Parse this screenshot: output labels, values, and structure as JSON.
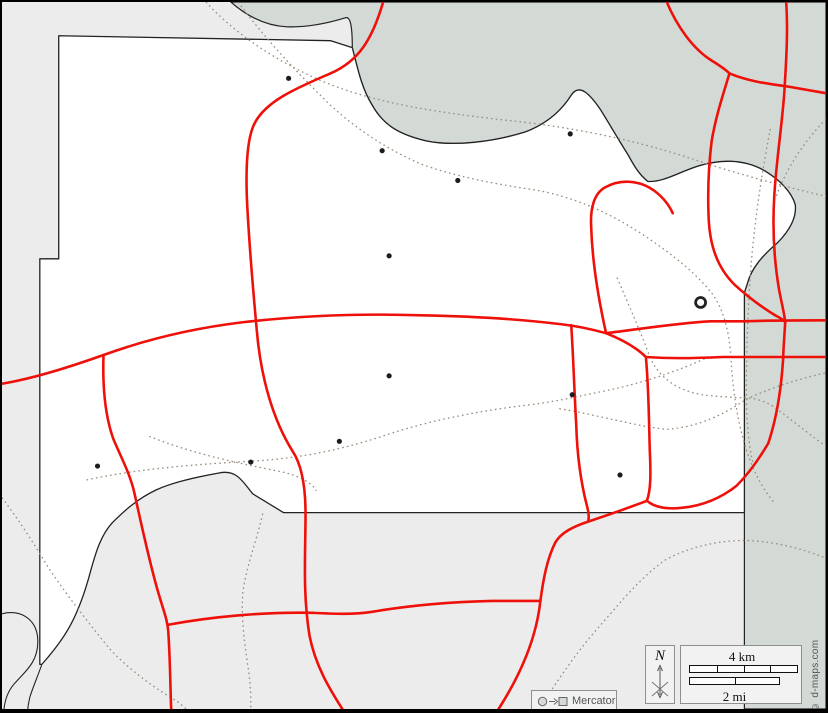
{
  "page": {
    "width": 828,
    "height": 713
  },
  "colors": {
    "background_outside": "#ececec",
    "county_fill": "#ffffff",
    "water_fill": "#d3dad6",
    "outline": "#222222",
    "boundary_dotted": "#9a8a7a",
    "road": "#ee1009",
    "town_dot": "#1c1c1c",
    "legend_box_fill": "#f2f2f2",
    "legend_box_border": "#8f8f8f"
  },
  "legend": {
    "projection_label": "Mercator",
    "projection_icons": [
      "circle-icon",
      "arrow-right-icon",
      "square-icon"
    ],
    "north_label": "N",
    "scale_km_label": "4 km",
    "scale_mi_label": "2 mi",
    "attribution": "© d-maps.com"
  },
  "scale_bar": {
    "km_segments": 4,
    "mi_segments": 2
  },
  "map": {
    "water_path": "M230,0 C248,16 266,24 286,25 C310,26 332,20 345,16 C350,14 352,24 352,46 C358,70 362,88 372,104 C382,122 396,133 426,140 C454,146 494,141 526,131 C547,123 562,110 572,94 C580,82 590,92 601,108 C611,124 620,140 629,154 C634,163 639,173 649,181 C665,182 681,171 701,165 C721,159 745,158 766,170 C781,179 793,191 797,204 C799,217 791,231 779,243 C765,255 753,268 749,284 C748,287 747,290 746,293 L746,713 L828,713 L828,0 Z",
    "county_path": "M57,34 L330,39 L352,46 C358,70 362,88 372,104 C382,122 396,133 426,140 C454,146 494,141 526,131 C547,123 562,110 572,94 C580,82 590,92 601,108 C611,124 620,140 629,154 C634,163 639,173 649,181 C665,182 681,171 701,165 C721,159 745,158 766,170 C781,179 793,191 797,204 C799,217 791,231 779,243 C765,255 753,268 749,284 C748,287 747,290 746,293 L746,515 L283,515 L252,496 C242,484 236,471 218,475 C196,479 172,484 155,492 C136,501 123,513 111,525 C99,538 94,556 89,574 C84,593 78,611 69,628 C60,645 48,659 40,668 L38,668 L38,259 L57,259 Z",
    "river_paths": [
      "M40,668 C36,680 31,691 28,701 C27,706 26,710 26,713",
      "M0,617 C18,612 36,622 36,645 C36,667 22,676 12,688 C6,695 3,704 2,713"
    ],
    "dotted_boundaries": [
      "M237,0 C264,36 294,69 330,104 C356,128 386,148 420,163 C452,175 492,183 532,189 C572,195 612,213 646,236 C676,256 700,276 715,296 C725,311 730,331 732,352 C734,392 740,432 752,463 C758,479 766,493 776,505",
      "M205,0 C232,30 272,58 322,80 C382,105 452,113 522,121 C592,129 652,144 702,161 C742,174 786,186 828,196",
      "M85,482 C140,470 200,466 252,463 C302,460 342,451 382,438 C432,421 482,412 532,406 C562,402 582,397 602,393 C642,385 680,372 710,358",
      "M0,500 C16,521 32,546 47,571 C67,601 87,626 107,651 C127,673 152,691 177,706 L185,713",
      "M148,438 C192,456 242,466 282,474 C302,479 312,486 316,493",
      "M560,410 C600,417 634,427 667,431 C700,429 727,415 747,401 C775,388 801,380 828,374",
      "M618,278 C630,306 641,331 651,358 C661,381 681,392 703,396 C719,398 735,399 747,399 C762,400 772,405 782,413 C802,428 816,440 828,448",
      "M262,516 C255,546 245,571 242,596 C240,621 244,649 248,676 C250,691 250,701 250,713",
      "M772,128 C764,170 757,215 753,262 C750,302 748,346 748,392 C748,420 750,450 756,470",
      "M828,118 C806,141 789,166 778,196",
      "M540,713 C560,681 581,651 601,629 C621,606 641,581 666,563 C691,549 721,543 747,543 C776,544 804,551 828,561"
    ],
    "roads": [
      "M383,0 C372,38 358,60 330,72 C298,86 266,99 254,122 C246,137 245,166 246,196 C248,242 252,287 256,331 C260,378 272,421 292,453 C302,468 305,491 305,516 C305,556 302,596 309,639 C315,670 330,694 342,713",
      "M0,385 C24,381 60,371 102,356 C146,340 192,329 242,323 C302,316 362,314 422,316 C472,317 522,320 562,325 C580,327 596,331 607,334",
      "M607,334 C640,330 676,324 712,322 L746,322 C773,321 800,321 828,321",
      "M607,334 C622,340 636,347 647,358 C676,360 700,359 724,358 L746,358 C773,358 800,358 828,358",
      "M102,356 C101,386 103,416 112,441 C121,462 129,477 133,495 C139,522 147,560 156,592 C162,613 166,622 167,634 C169,662 169,688 170,713",
      "M167,628 C210,620 262,615 312,616 C333,617 352,618 372,615 C412,608 452,605 492,604 C510,604 527,604 541,604",
      "M770,445 C760,462 750,476 738,488 C723,500 704,508 684,510 C667,512 655,509 648,503 C630,510 610,517 589,524 C574,529 562,535 556,545 C548,561 544,581 541,604 C537,642 520,680 499,713",
      "M572,326 C574,356 575,391 577,426 C578,461 582,486 588,509 C590,516 590,520 589,524",
      "M647,358 C650,390 650,424 651,454 C652,477 652,492 648,503",
      "M668,0 C678,24 694,47 713,59 C721,64 727,68 731,72 C725,92 717,116 713,141 C710,166 709,191 710,216 C711,246 719,268 736,285 C749,297 764,308 777,316 C783,319 786,321 787,323 C786,341 785,351 785,359 C783,391 778,421 770,445",
      "M731,72 C748,79 765,82 788,85 C805,88 817,90 828,92",
      "M788,0 C790,30 788,60 786,93 C783,131 778,161 776,196 C774,230 776,262 781,291 C783,302 786,313 787,323",
      "M607,334 C599,298 593,260 592,226 C591,208 595,193 606,187 C622,178 641,180 655,190 C663,196 670,204 674,213"
    ],
    "towns": [
      {
        "x": 288,
        "y": 77
      },
      {
        "x": 382,
        "y": 150
      },
      {
        "x": 458,
        "y": 180
      },
      {
        "x": 571,
        "y": 133
      },
      {
        "x": 389,
        "y": 256
      },
      {
        "x": 389,
        "y": 377
      },
      {
        "x": 573,
        "y": 396
      },
      {
        "x": 339,
        "y": 443
      },
      {
        "x": 250,
        "y": 464
      },
      {
        "x": 96,
        "y": 468
      },
      {
        "x": 621,
        "y": 477
      }
    ],
    "county_seat": {
      "x": 702,
      "y": 303
    }
  }
}
